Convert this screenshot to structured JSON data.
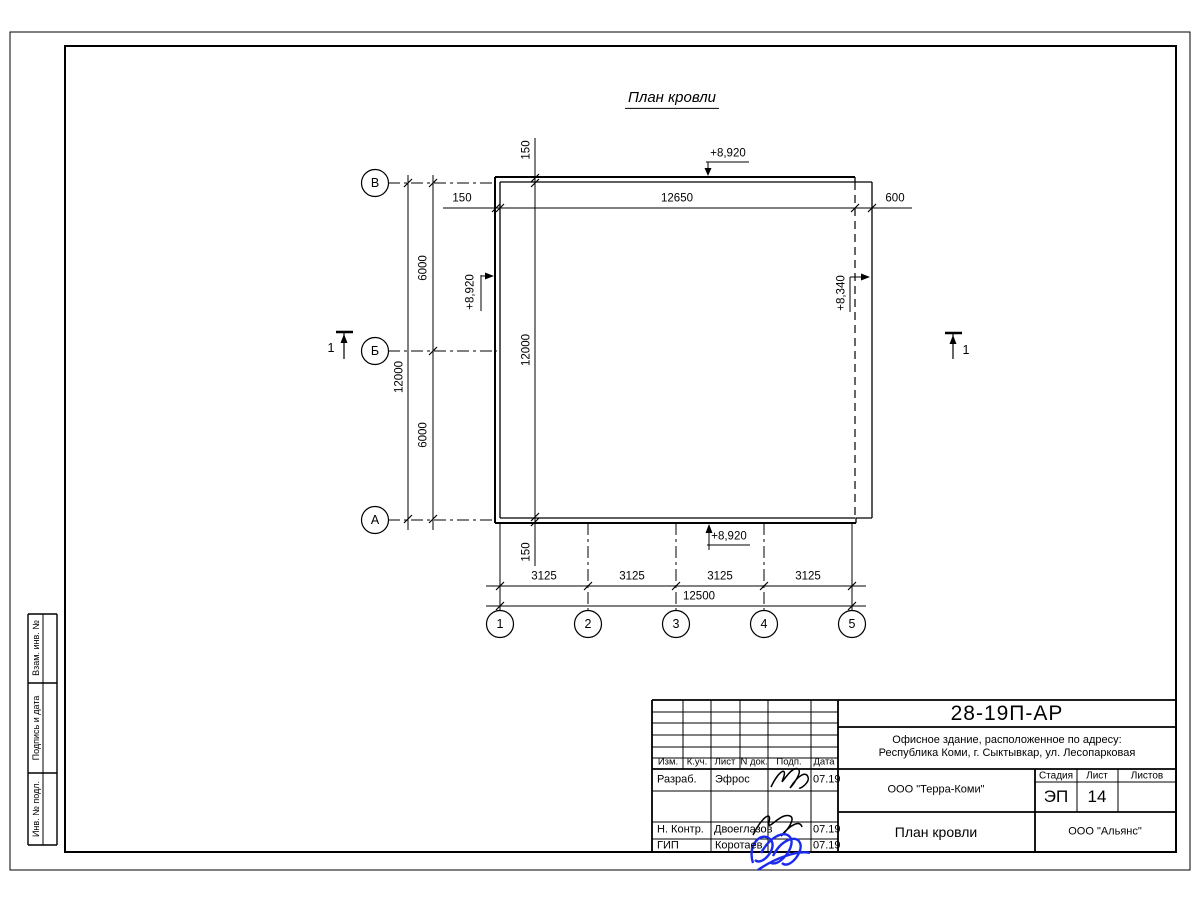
{
  "drawing": {
    "title": "План кровли",
    "row_axes": [
      "В",
      "Б",
      "А"
    ],
    "col_axes": [
      "1",
      "2",
      "3",
      "4",
      "5"
    ],
    "section_mark": "1",
    "dims": {
      "top_overhang_left": "150",
      "top_span": "12650",
      "top_overhang_right": "600",
      "left_span_upper": "6000",
      "left_span_lower": "6000",
      "left_total": "12000",
      "inner_overhang_top": "150",
      "inner_span": "12000",
      "inner_overhang_bottom": "150",
      "bottom_bays": [
        "3125",
        "3125",
        "3125",
        "3125"
      ],
      "bottom_total": "12500"
    },
    "elevations": {
      "top": "+8,920",
      "left": "+8,920",
      "right": "+8,340",
      "bottom": "+8,920"
    }
  },
  "titleblock": {
    "doc_number": "28-19П-АР",
    "project_line1": "Офисное здание, расположенное по адресу:",
    "project_line2": "Республика Коми, г. Сыктывкар, ул. Лесопарковая",
    "header": {
      "izm": "Изм.",
      "kuch": "К.уч.",
      "list": "Лист",
      "ndok": "N док.",
      "podp": "Подп.",
      "data": "Дата"
    },
    "rows": [
      {
        "role": "Разраб.",
        "name": "Эфрос",
        "date": "07.19"
      },
      {
        "role": "Н. Контр.",
        "name": "Двоеглазов",
        "date": "07.19"
      },
      {
        "role": "ГИП",
        "name": "Коротаев",
        "date": "07.19"
      }
    ],
    "org_middle": "ООО \"Терра-Коми\"",
    "stage_label": "Стадия",
    "sheet_label": "Лист",
    "sheets_label": "Листов",
    "stage": "ЭП",
    "sheet_number": "14",
    "sheets_total": "",
    "sheet_title": "План кровли",
    "org_bottom": "ООО \"Альянс\""
  },
  "sidebar": {
    "labels": [
      "Взам. инв. №",
      "Подпись и дата",
      "Инв. № подл."
    ]
  },
  "colors": {
    "line": "#000000",
    "signature_blue": "#1b2bee",
    "paper": "#ffffff"
  }
}
